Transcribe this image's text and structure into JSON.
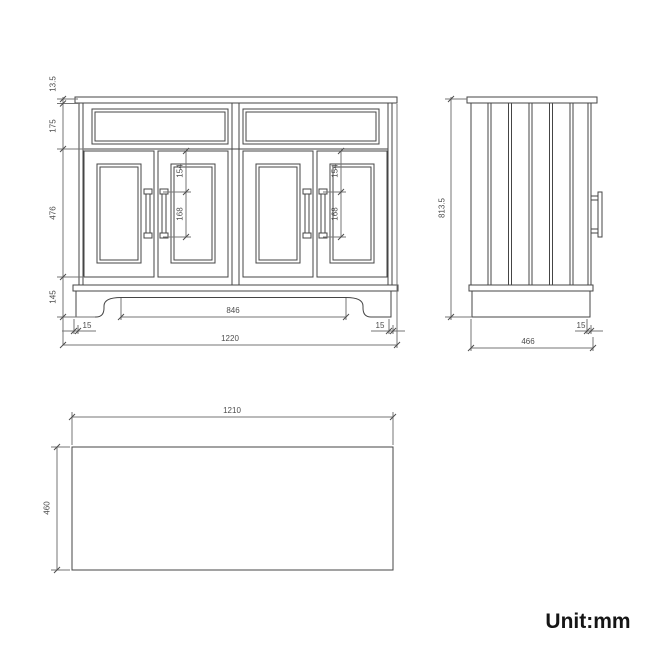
{
  "unit": {
    "label": "Unit:mm"
  },
  "front_view": {
    "countertop_thickness": "13.5",
    "top_drawer_height": "175",
    "door_height": "476",
    "plinth_height": "145",
    "handle_top_offset": "154",
    "handle_length": "168",
    "plinth_opening_width": "846",
    "plinth_side_inset_left": "15",
    "plinth_side_inset_right": "15",
    "overall_width": "1220"
  },
  "side_view": {
    "overall_height": "813.5",
    "door_inset": "15",
    "overall_depth": "466"
  },
  "top_view": {
    "width": "1210",
    "depth": "460"
  }
}
